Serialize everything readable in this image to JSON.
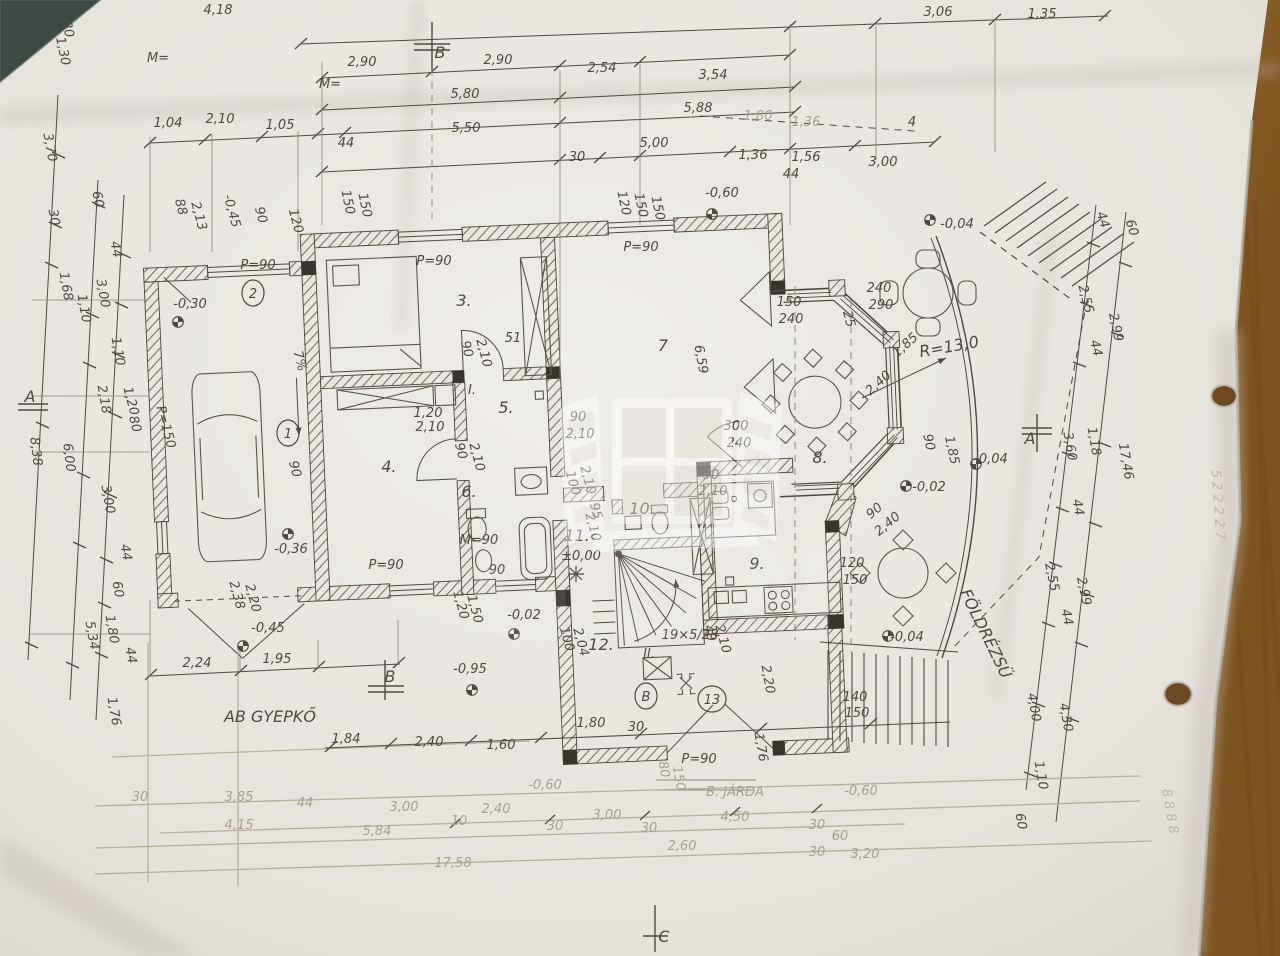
{
  "meta": {
    "title": "Photographed hand-drawn ground floor plan (FÖLDSZINT) with dimension chains"
  },
  "watermark": {
    "text": "GDN"
  },
  "colors": {
    "paper": "#e8e4de",
    "wood": "#9c6c31",
    "dark_corner": "#3c4a43",
    "ink": "#4f4941",
    "faded_ink": "#a89f92"
  },
  "annotations": [
    {
      "t": "4,18",
      "x": 218,
      "y": 14
    },
    {
      "t": "3,06",
      "x": 938,
      "y": 16
    },
    {
      "t": "1,35",
      "x": 1042,
      "y": 18
    },
    {
      "t": "2,90",
      "x": 362,
      "y": 66
    },
    {
      "t": "B",
      "x": 440,
      "y": 58,
      "c": "b"
    },
    {
      "t": "2,90",
      "x": 498,
      "y": 64
    },
    {
      "t": "2,54",
      "x": 602,
      "y": 72
    },
    {
      "t": "3,54",
      "x": 713,
      "y": 79
    },
    {
      "t": "M=",
      "x": 158,
      "y": 62,
      "s": 10
    },
    {
      "t": "M=",
      "x": 330,
      "y": 88,
      "s": 10
    },
    {
      "t": "5,80",
      "x": 465,
      "y": 98
    },
    {
      "t": "5,88",
      "x": 698,
      "y": 112
    },
    {
      "t": "1,80",
      "x": 758,
      "y": 120,
      "c": "f"
    },
    {
      "t": "1,36",
      "x": 806,
      "y": 126,
      "c": "f"
    },
    {
      "t": "4",
      "x": 912,
      "y": 126,
      "s": 10
    },
    {
      "t": "1,04",
      "x": 168,
      "y": 127
    },
    {
      "t": "2,10",
      "x": 220,
      "y": 123
    },
    {
      "t": "1,05",
      "x": 280,
      "y": 129
    },
    {
      "t": "44",
      "x": 346,
      "y": 147,
      "s": 10
    },
    {
      "t": "5,50",
      "x": 466,
      "y": 132
    },
    {
      "t": "30",
      "x": 577,
      "y": 161,
      "s": 10
    },
    {
      "t": "5,00",
      "x": 654,
      "y": 147
    },
    {
      "t": "1,36",
      "x": 753,
      "y": 159
    },
    {
      "t": "1,56",
      "x": 806,
      "y": 161
    },
    {
      "t": "44",
      "x": 791,
      "y": 178,
      "s": 10
    },
    {
      "t": "3,00",
      "x": 883,
      "y": 166
    },
    {
      "t": "-0,60",
      "x": 722,
      "y": 197
    },
    {
      "t": "120",
      "x": 620,
      "y": 204,
      "r": 78,
      "s": 10
    },
    {
      "t": "150",
      "x": 637,
      "y": 206,
      "r": 78,
      "s": 10
    },
    {
      "t": "150",
      "x": 654,
      "y": 209,
      "r": 78,
      "s": 10
    },
    {
      "t": "150",
      "x": 344,
      "y": 203,
      "r": 78,
      "s": 10
    },
    {
      "t": "150",
      "x": 361,
      "y": 206,
      "r": 78,
      "s": 10
    },
    {
      "t": "-0,04",
      "x": 957,
      "y": 228
    },
    {
      "t": "44",
      "x": 1099,
      "y": 221,
      "r": 72,
      "s": 10
    },
    {
      "t": "60",
      "x": 1128,
      "y": 229,
      "r": 72,
      "s": 10
    },
    {
      "t": "30",
      "x": 64,
      "y": 30,
      "r": 78,
      "s": 10
    },
    {
      "t": "1,30",
      "x": 59,
      "y": 52,
      "r": 78,
      "s": 10
    },
    {
      "t": "3,70",
      "x": 46,
      "y": 148,
      "r": 80
    },
    {
      "t": "30",
      "x": 50,
      "y": 218,
      "r": 80,
      "s": 10
    },
    {
      "t": "60",
      "x": 94,
      "y": 200,
      "r": 80,
      "s": 10
    },
    {
      "t": "88",
      "x": 177,
      "y": 208,
      "r": 75,
      "s": 10
    },
    {
      "t": "2,13",
      "x": 195,
      "y": 217,
      "r": 75,
      "s": 10
    },
    {
      "t": "-0,45",
      "x": 228,
      "y": 212,
      "r": 75,
      "s": 10
    },
    {
      "t": "90",
      "x": 257,
      "y": 216,
      "r": 75,
      "s": 10
    },
    {
      "t": "120",
      "x": 292,
      "y": 222,
      "r": 75,
      "s": 10
    },
    {
      "t": "1,68",
      "x": 62,
      "y": 287,
      "r": 80
    },
    {
      "t": "1,10",
      "x": 80,
      "y": 309,
      "r": 80,
      "s": 10
    },
    {
      "t": "3,00",
      "x": 99,
      "y": 294,
      "r": 80
    },
    {
      "t": "44",
      "x": 112,
      "y": 250,
      "r": 80,
      "s": 10
    },
    {
      "t": "1,10",
      "x": 114,
      "y": 352,
      "r": 80,
      "s": 10
    },
    {
      "t": "A",
      "x": 30,
      "y": 402,
      "c": "b"
    },
    {
      "t": "2,18",
      "x": 100,
      "y": 400,
      "r": 80
    },
    {
      "t": "1,20",
      "x": 127,
      "y": 402,
      "r": 75,
      "s": 10
    },
    {
      "t": "80",
      "x": 131,
      "y": 425,
      "r": 75,
      "s": 10
    },
    {
      "t": "P=150",
      "x": 162,
      "y": 428,
      "r": 75,
      "s": 10
    },
    {
      "t": "8,38",
      "x": 32,
      "y": 452,
      "r": 83
    },
    {
      "t": "6,00",
      "x": 65,
      "y": 458,
      "r": 83
    },
    {
      "t": "3,00",
      "x": 104,
      "y": 500,
      "r": 80
    },
    {
      "t": "44",
      "x": 122,
      "y": 553,
      "r": 80,
      "s": 10
    },
    {
      "t": "60",
      "x": 114,
      "y": 590,
      "r": 80,
      "s": 10
    },
    {
      "t": "1,80",
      "x": 108,
      "y": 630,
      "r": 80
    },
    {
      "t": "44",
      "x": 127,
      "y": 656,
      "r": 80,
      "s": 10
    },
    {
      "t": "5,34",
      "x": 88,
      "y": 636,
      "r": 80
    },
    {
      "t": "1,76",
      "x": 110,
      "y": 712,
      "r": 80
    },
    {
      "t": "P=90",
      "x": 258,
      "y": 269,
      "s": 11
    },
    {
      "t": "-0,30",
      "x": 190,
      "y": 308
    },
    {
      "t": "2",
      "x": 253,
      "y": 298,
      "c": "circ"
    },
    {
      "t": "1",
      "x": 288,
      "y": 438,
      "c": "circ"
    },
    {
      "t": "7%",
      "x": 296,
      "y": 362,
      "r": 75,
      "s": 11
    },
    {
      "t": "90",
      "x": 291,
      "y": 470,
      "r": 75,
      "s": 10
    },
    {
      "t": "-0,36",
      "x": 291,
      "y": 553,
      "s": 11
    },
    {
      "t": "2,38",
      "x": 233,
      "y": 596,
      "r": 75,
      "s": 10
    },
    {
      "t": "2,20",
      "x": 249,
      "y": 599,
      "r": 75,
      "s": 10
    },
    {
      "t": "-0,45",
      "x": 268,
      "y": 632
    },
    {
      "t": "2,24",
      "x": 197,
      "y": 667
    },
    {
      "t": "1,95",
      "x": 277,
      "y": 663
    },
    {
      "t": "B",
      "x": 390,
      "y": 682,
      "c": "b"
    },
    {
      "t": "-0,95",
      "x": 470,
      "y": 673
    },
    {
      "t": "AB GYEPKŐ",
      "x": 270,
      "y": 722,
      "c": "b"
    },
    {
      "t": "P=90",
      "x": 434,
      "y": 265,
      "s": 11
    },
    {
      "t": "3.",
      "x": 464,
      "y": 306,
      "c": "b"
    },
    {
      "t": "P=90",
      "x": 641,
      "y": 251,
      "s": 11
    },
    {
      "t": "7",
      "x": 663,
      "y": 351,
      "c": "b"
    },
    {
      "t": "6,59",
      "x": 697,
      "y": 360,
      "r": 80
    },
    {
      "t": "51",
      "x": 513,
      "y": 342,
      "s": 11
    },
    {
      "t": "90",
      "x": 463,
      "y": 350,
      "r": 75,
      "s": 10
    },
    {
      "t": "2,10",
      "x": 480,
      "y": 354,
      "r": 75,
      "s": 10
    },
    {
      "t": "I.",
      "x": 472,
      "y": 394,
      "s": 10
    },
    {
      "t": "5.",
      "x": 506,
      "y": 413,
      "c": "b"
    },
    {
      "t": "1,20",
      "x": 428,
      "y": 417,
      "s": 10
    },
    {
      "t": "2,10",
      "x": 430,
      "y": 431,
      "s": 10
    },
    {
      "t": "90",
      "x": 578,
      "y": 421,
      "s": 10
    },
    {
      "t": "2,10",
      "x": 580,
      "y": 438,
      "s": 10
    },
    {
      "t": "4.",
      "x": 389,
      "y": 472,
      "c": "b"
    },
    {
      "t": "P=90",
      "x": 386,
      "y": 569,
      "s": 11
    },
    {
      "t": "90",
      "x": 457,
      "y": 452,
      "r": 75,
      "s": 10
    },
    {
      "t": "2,10",
      "x": 473,
      "y": 458,
      "r": 75,
      "s": 10
    },
    {
      "t": "6.",
      "x": 469,
      "y": 497,
      "c": "b"
    },
    {
      "t": "M=90",
      "x": 479,
      "y": 544,
      "s": 10
    },
    {
      "t": "90",
      "x": 497,
      "y": 574,
      "s": 10
    },
    {
      "t": "1,20",
      "x": 457,
      "y": 606,
      "r": 75,
      "s": 10
    },
    {
      "t": "1,50",
      "x": 471,
      "y": 610,
      "r": 75,
      "s": 10
    },
    {
      "t": "-0,02",
      "x": 524,
      "y": 619,
      "s": 11
    },
    {
      "t": "100",
      "x": 569,
      "y": 484,
      "r": 75,
      "s": 10
    },
    {
      "t": "2,10",
      "x": 584,
      "y": 481,
      "r": 75,
      "s": 10
    },
    {
      "t": "95",
      "x": 592,
      "y": 512,
      "r": 75,
      "s": 10
    },
    {
      "t": "2,10",
      "x": 589,
      "y": 528,
      "r": 75,
      "s": 10
    },
    {
      "t": "10.",
      "x": 642,
      "y": 514,
      "c": "b"
    },
    {
      "t": "11.",
      "x": 577,
      "y": 541,
      "c": "b"
    },
    {
      "t": "±0,00",
      "x": 581,
      "y": 560,
      "s": 11
    },
    {
      "t": "90",
      "x": 711,
      "y": 479,
      "s": 10
    },
    {
      "t": "2,10",
      "x": 713,
      "y": 495,
      "s": 10
    },
    {
      "t": "300",
      "x": 736,
      "y": 430
    },
    {
      "t": "240",
      "x": 739,
      "y": 447
    },
    {
      "t": "9.",
      "x": 757,
      "y": 569,
      "c": "b"
    },
    {
      "t": "40",
      "x": 706,
      "y": 634,
      "r": 75,
      "s": 10
    },
    {
      "t": "2,10",
      "x": 719,
      "y": 640,
      "r": 75,
      "s": 10
    },
    {
      "t": "2,20",
      "x": 764,
      "y": 680,
      "r": 80,
      "s": 10
    },
    {
      "t": "1,76",
      "x": 757,
      "y": 748,
      "r": 80,
      "s": 10
    },
    {
      "t": "12.",
      "x": 601,
      "y": 650,
      "c": "b"
    },
    {
      "t": "II.",
      "x": 649,
      "y": 658,
      "s": 11
    },
    {
      "t": "B",
      "x": 646,
      "y": 701,
      "c": "circ"
    },
    {
      "t": "13",
      "x": 712,
      "y": 704,
      "c": "circ"
    },
    {
      "t": "19×5/28",
      "x": 690,
      "y": 639,
      "s": 10
    },
    {
      "t": "1,80",
      "x": 591,
      "y": 727
    },
    {
      "t": "30",
      "x": 636,
      "y": 731,
      "s": 10
    },
    {
      "t": "P=90",
      "x": 699,
      "y": 763,
      "s": 11
    },
    {
      "t": "100",
      "x": 563,
      "y": 640,
      "r": 75,
      "s": 10
    },
    {
      "t": "2,04",
      "x": 577,
      "y": 643,
      "r": 75,
      "s": 10
    },
    {
      "t": "150",
      "x": 789,
      "y": 306,
      "s": 10
    },
    {
      "t": "240",
      "x": 791,
      "y": 323,
      "s": 10
    },
    {
      "t": "240",
      "x": 879,
      "y": 292,
      "s": 11
    },
    {
      "t": "290",
      "x": 881,
      "y": 309,
      "s": 11
    },
    {
      "t": "25",
      "x": 845,
      "y": 320,
      "r": 75,
      "s": 10
    },
    {
      "t": "1,85",
      "x": 908,
      "y": 348,
      "r": -42,
      "s": 10
    },
    {
      "t": "2,40",
      "x": 881,
      "y": 386,
      "r": -42,
      "s": 10
    },
    {
      "t": "R=13,0",
      "x": 950,
      "y": 352,
      "r": -10,
      "c": "b"
    },
    {
      "t": "90",
      "x": 877,
      "y": 514,
      "r": -40,
      "s": 10
    },
    {
      "t": "2,40",
      "x": 890,
      "y": 527,
      "r": -40,
      "s": 10
    },
    {
      "t": "-0,02",
      "x": 929,
      "y": 491,
      "s": 11
    },
    {
      "t": "8.",
      "x": 820,
      "y": 463,
      "c": "b"
    },
    {
      "t": "120",
      "x": 852,
      "y": 567,
      "s": 10
    },
    {
      "t": "150",
      "x": 855,
      "y": 584,
      "s": 10
    },
    {
      "t": "90",
      "x": 925,
      "y": 443,
      "r": 78,
      "s": 10
    },
    {
      "t": "1,85",
      "x": 948,
      "y": 451,
      "r": 78,
      "s": 10
    },
    {
      "t": "-0,04",
      "x": 991,
      "y": 463,
      "s": 11
    },
    {
      "t": "A",
      "x": 1030,
      "y": 444,
      "c": "b"
    },
    {
      "t": "-0,04",
      "x": 907,
      "y": 641,
      "s": 11
    },
    {
      "t": "140",
      "x": 855,
      "y": 701,
      "s": 10
    },
    {
      "t": "150",
      "x": 857,
      "y": 717,
      "s": 10
    },
    {
      "t": "FÖLDRÉZSÜ",
      "x": 981,
      "y": 636,
      "r": 64,
      "c": "b"
    },
    {
      "t": "2,55",
      "x": 1082,
      "y": 300,
      "r": 76
    },
    {
      "t": "2,99",
      "x": 1112,
      "y": 328,
      "r": 78
    },
    {
      "t": "44",
      "x": 1092,
      "y": 349,
      "r": 76,
      "s": 10
    },
    {
      "t": "3,60",
      "x": 1066,
      "y": 447,
      "r": 80
    },
    {
      "t": "1,18",
      "x": 1090,
      "y": 442,
      "r": 80,
      "s": 10
    },
    {
      "t": "17,46",
      "x": 1122,
      "y": 462,
      "r": 80
    },
    {
      "t": "44",
      "x": 1074,
      "y": 508,
      "r": 80,
      "s": 10
    },
    {
      "t": "2,55",
      "x": 1048,
      "y": 578,
      "r": 78
    },
    {
      "t": "2,99",
      "x": 1080,
      "y": 592,
      "r": 78
    },
    {
      "t": "44",
      "x": 1063,
      "y": 618,
      "r": 78,
      "s": 10
    },
    {
      "t": "4,00",
      "x": 1030,
      "y": 708,
      "r": 80
    },
    {
      "t": "4,30",
      "x": 1062,
      "y": 718,
      "r": 80
    },
    {
      "t": "1,10",
      "x": 1037,
      "y": 776,
      "r": 80,
      "s": 10
    },
    {
      "t": "60",
      "x": 1017,
      "y": 822,
      "r": 80,
      "s": 10
    },
    {
      "t": "1,84",
      "x": 346,
      "y": 743
    },
    {
      "t": "2,40",
      "x": 429,
      "y": 746
    },
    {
      "t": "1,60",
      "x": 501,
      "y": 749
    },
    {
      "t": "80",
      "x": 660,
      "y": 770,
      "r": 80,
      "c": "f",
      "s": 10
    },
    {
      "t": "150",
      "x": 675,
      "y": 779,
      "r": 80,
      "c": "f",
      "s": 10
    },
    {
      "t": "-0,60",
      "x": 545,
      "y": 789,
      "c": "f"
    },
    {
      "t": "B. JÁRDA",
      "x": 735,
      "y": 796,
      "c": "f"
    },
    {
      "t": "-0,60",
      "x": 861,
      "y": 795,
      "c": "f"
    },
    {
      "t": "30",
      "x": 140,
      "y": 801,
      "c": "f",
      "s": 10
    },
    {
      "t": "3,85",
      "x": 239,
      "y": 801,
      "c": "f"
    },
    {
      "t": "44",
      "x": 305,
      "y": 807,
      "c": "f",
      "s": 10
    },
    {
      "t": "3,00",
      "x": 404,
      "y": 811,
      "c": "f"
    },
    {
      "t": "2,40",
      "x": 496,
      "y": 813,
      "c": "f"
    },
    {
      "t": "10",
      "x": 459,
      "y": 825,
      "c": "f",
      "s": 10
    },
    {
      "t": "30",
      "x": 555,
      "y": 830,
      "c": "f",
      "s": 10
    },
    {
      "t": "3,00",
      "x": 607,
      "y": 819,
      "c": "f"
    },
    {
      "t": "30",
      "x": 649,
      "y": 832,
      "c": "f",
      "s": 10
    },
    {
      "t": "4,50",
      "x": 735,
      "y": 821,
      "c": "f"
    },
    {
      "t": "30",
      "x": 817,
      "y": 829,
      "c": "f",
      "s": 10
    },
    {
      "t": "60",
      "x": 840,
      "y": 840,
      "c": "f",
      "s": 10
    },
    {
      "t": "3,20",
      "x": 865,
      "y": 858,
      "c": "f"
    },
    {
      "t": "4,15",
      "x": 239,
      "y": 829,
      "c": "f"
    },
    {
      "t": "5,84",
      "x": 377,
      "y": 835,
      "c": "f"
    },
    {
      "t": "2,60",
      "x": 682,
      "y": 850,
      "c": "f"
    },
    {
      "t": "30",
      "x": 817,
      "y": 856,
      "c": "f",
      "s": 10
    },
    {
      "t": "17,58",
      "x": 453,
      "y": 867,
      "c": "f"
    },
    {
      "t": "C",
      "x": 664,
      "y": 942,
      "c": "b"
    },
    {
      "t": "5 2 2 2 2 7",
      "x": 1214,
      "y": 505,
      "r": 86,
      "c": "s",
      "s": 11
    },
    {
      "t": "8 8 8 8",
      "x": 1166,
      "y": 812,
      "r": 80,
      "c": "s",
      "s": 10
    }
  ]
}
